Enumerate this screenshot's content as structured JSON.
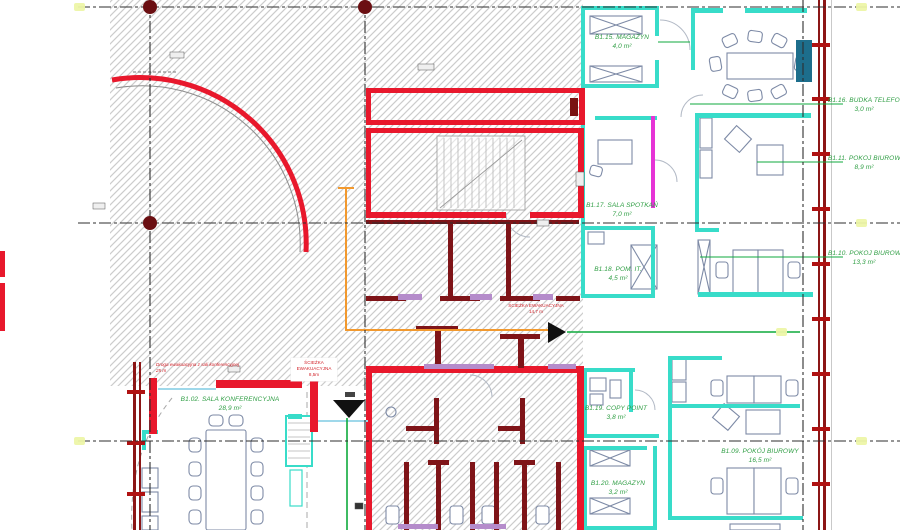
{
  "drawing": {
    "type": "architectural-floor-plan",
    "rooms": [
      {
        "name": "B1.02. SALA KONFERENCYJNA",
        "area": "28,9 m²"
      },
      {
        "name": "B1.15. MAGAZYN",
        "area": "4,0 m²"
      },
      {
        "name": "B1.16. BUDKA TELEFON",
        "area": "3,0 m²"
      },
      {
        "name": "B1.11. POKÓJ BIUROWY",
        "area": "8,9 m²"
      },
      {
        "name": "B1.17. SALA SPOTKAŃ",
        "area": "7,0 m²"
      },
      {
        "name": "B1.18. POM. IT.",
        "area": "4,5 m²"
      },
      {
        "name": "B1.10. POKÓJ BIUROWY",
        "area": "13,3 m²"
      },
      {
        "name": "B1.19. COPY POINT",
        "area": "3,8 m²"
      },
      {
        "name": "B1.20. MAGAZYN",
        "area": "3,2 m²"
      },
      {
        "name": "B1.09. POKÓJ BIUROWY",
        "area": "16,5 m²"
      }
    ],
    "annotations": {
      "evac_box": {
        "line1": "ŚCIEŻKA",
        "line2": "EWAKUACYJNA",
        "line3": "8,5m"
      },
      "evac_right": {
        "line1": "ŚCIEŻKA EWAKUACYJNA",
        "line2": "14,7 m"
      },
      "conference_note": {
        "line1": "Droga ewakuacyjna z sali konferencyjnej",
        "line2": "25 m"
      }
    },
    "colors": {
      "wall_red": "#e8182c",
      "wall_maroon": "#8c1616",
      "partition_teal": "#38dcc9",
      "label_green": "#2f9e44",
      "evac_orange": "#f2992e",
      "evac_green": "#0faa3c",
      "accent_magenta": "#e633d6",
      "accent_lilac": "#b58ccb"
    }
  }
}
